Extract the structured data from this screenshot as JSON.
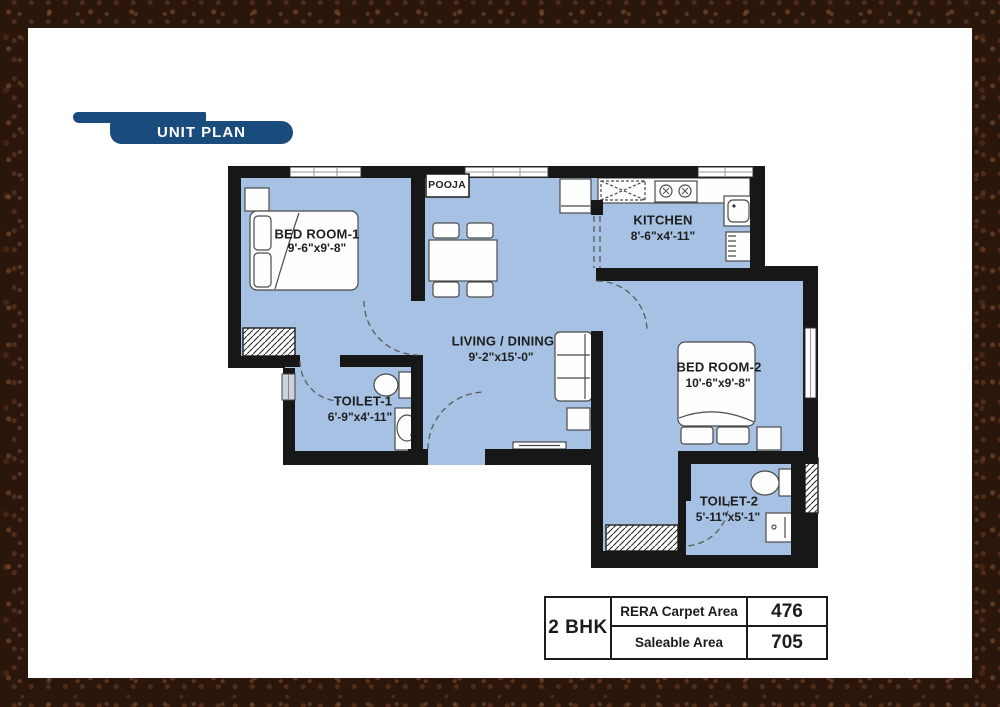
{
  "header": {
    "title": "UNIT PLAN"
  },
  "floor_plan": {
    "rooms": [
      {
        "name": "BED ROOM-1",
        "dims": "9'-6\"x9'-8\""
      },
      {
        "name": "POOJA",
        "dims": ""
      },
      {
        "name": "KITCHEN",
        "dims": "8'-6\"x4'-11\""
      },
      {
        "name": "LIVING / DINING",
        "dims": "9'-2\"x15'-0\""
      },
      {
        "name": "TOILET-1",
        "dims": "6'-9\"x4'-11\""
      },
      {
        "name": "BED ROOM-2",
        "dims": "10'-6\"x9'-8\""
      },
      {
        "name": "TOILET-2",
        "dims": "5'-11\"x5'-1\""
      }
    ],
    "colors": {
      "floor": "#a6c1e3",
      "wall": "#171717",
      "header_navy": "#1a4b7d"
    }
  },
  "summary_table": {
    "unit_type": "2 BHK",
    "rows": [
      {
        "label": "RERA Carpet Area",
        "value": "476"
      },
      {
        "label": "Saleable Area",
        "value": "705"
      }
    ]
  }
}
